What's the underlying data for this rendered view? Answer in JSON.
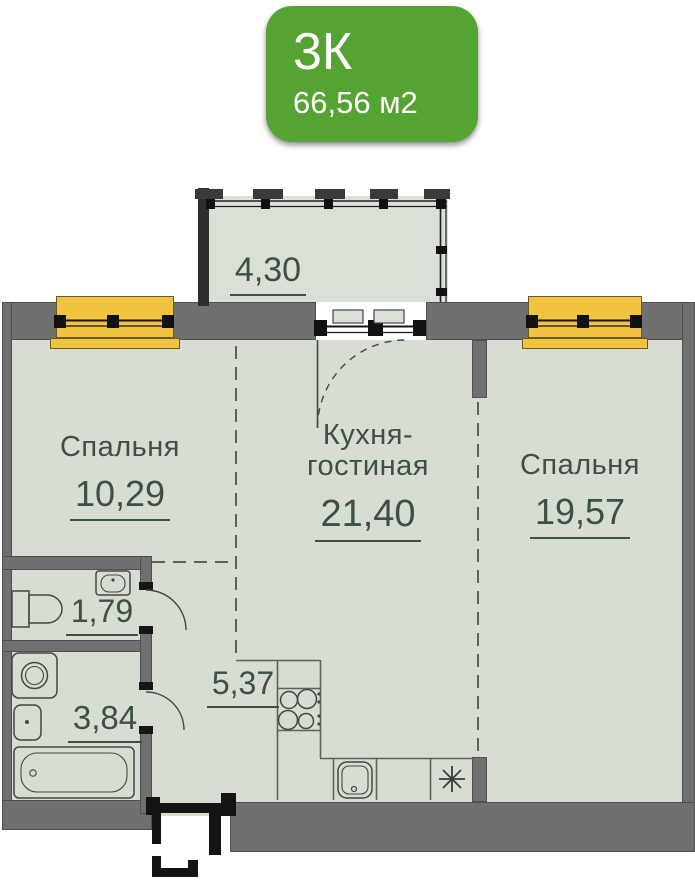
{
  "badge": {
    "rooms_label": "3К",
    "area_label": "66,56 м2"
  },
  "rooms": {
    "balcony": {
      "area": "4,30"
    },
    "bedroom_left": {
      "name": "Спальня",
      "area": "10,29"
    },
    "kitchen_living": {
      "name_line1": "Кухня-",
      "name_line2": "гостиная",
      "area": "21,40"
    },
    "bedroom_right": {
      "name": "Спальня",
      "area": "19,57"
    },
    "wc": {
      "area": "1,79"
    },
    "bathroom": {
      "area": "3,84"
    },
    "hallway": {
      "area": "5,37"
    }
  },
  "symbols": {
    "kitchen_appliance": "asterisk"
  },
  "colors": {
    "badge_green": "#55A333",
    "window_yellow": "#F2C340",
    "floor": "#D7DDD2",
    "wall_gray": "#707070",
    "label_text": "#3C5046"
  }
}
